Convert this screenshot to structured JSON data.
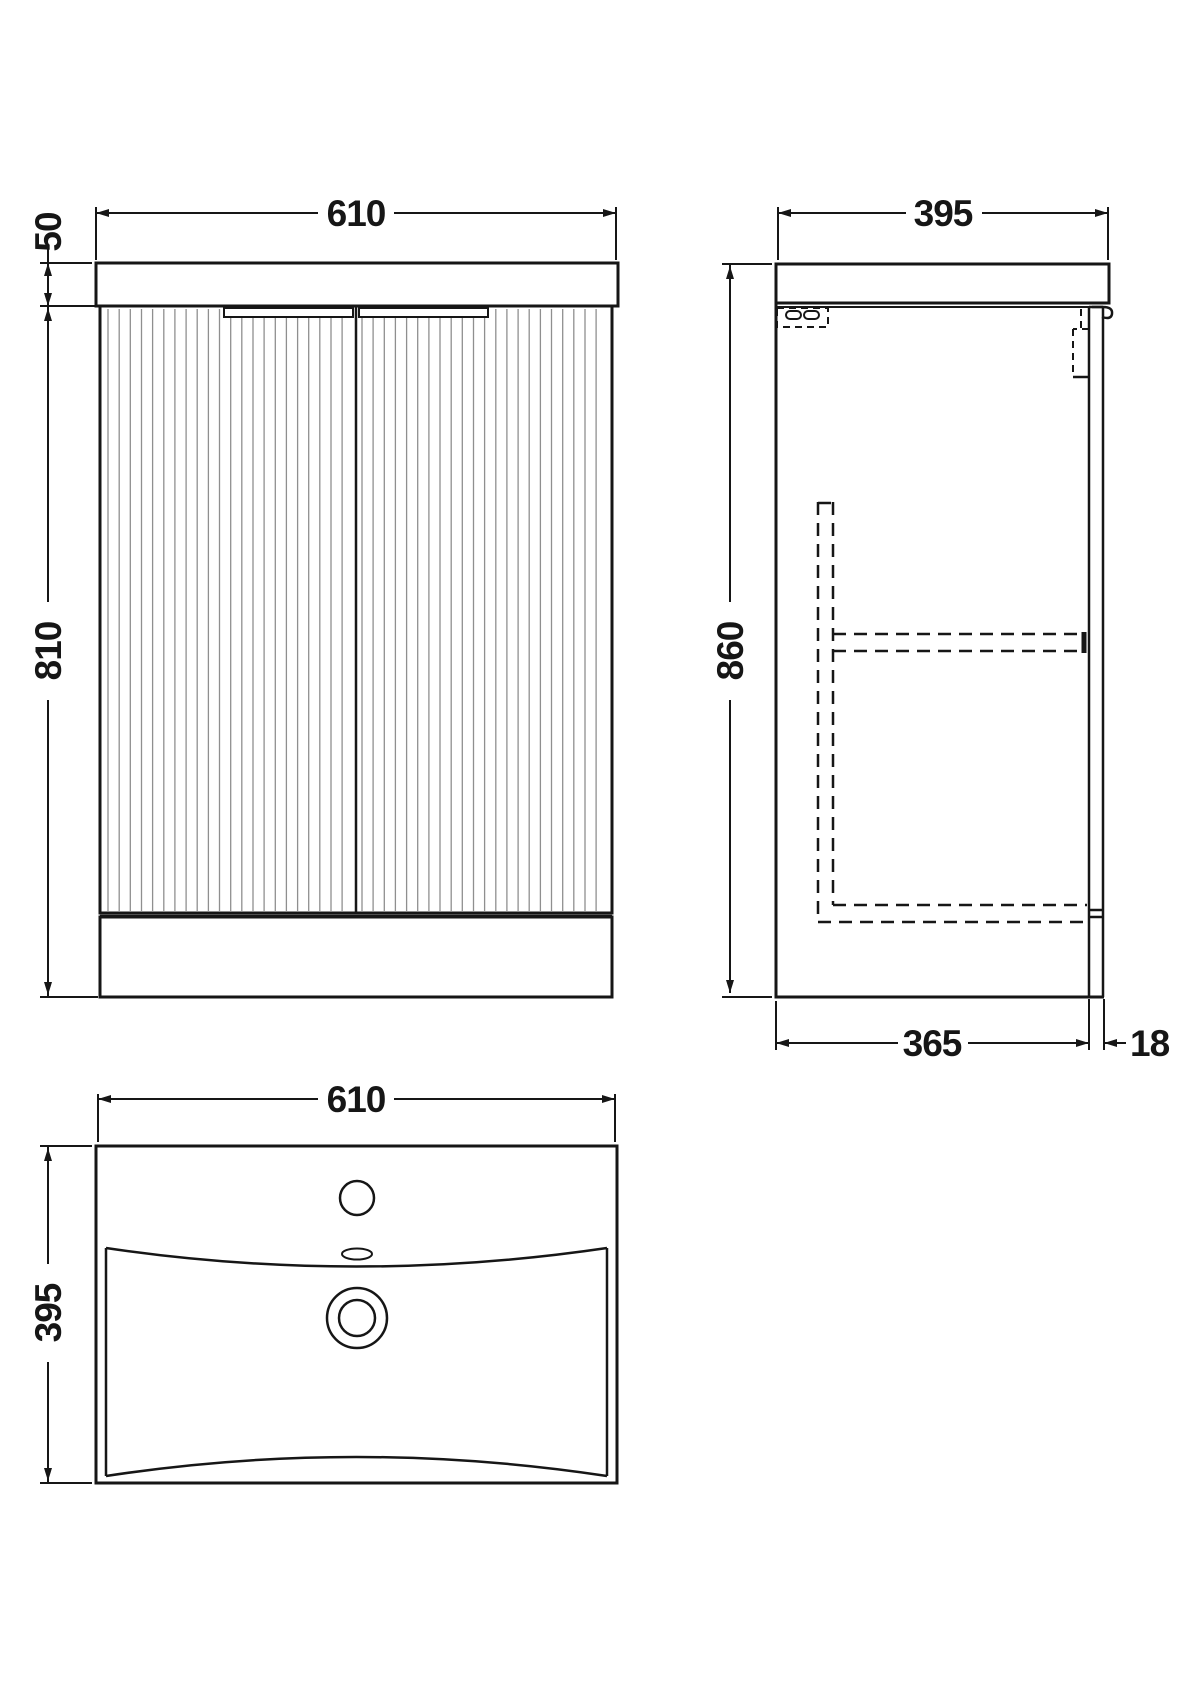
{
  "views": {
    "front": {
      "width_mm": "610",
      "worktop_height_mm": "50",
      "cabinet_height_mm": "810"
    },
    "side": {
      "depth_mm": "395",
      "height_mm": "860",
      "body_depth_mm": "365",
      "door_thickness_mm": "18"
    },
    "plan": {
      "width_mm": "610",
      "depth_mm": "395"
    }
  },
  "colors": {
    "line": "#161616",
    "flute": "#8f8f8f",
    "background": "#ffffff"
  }
}
